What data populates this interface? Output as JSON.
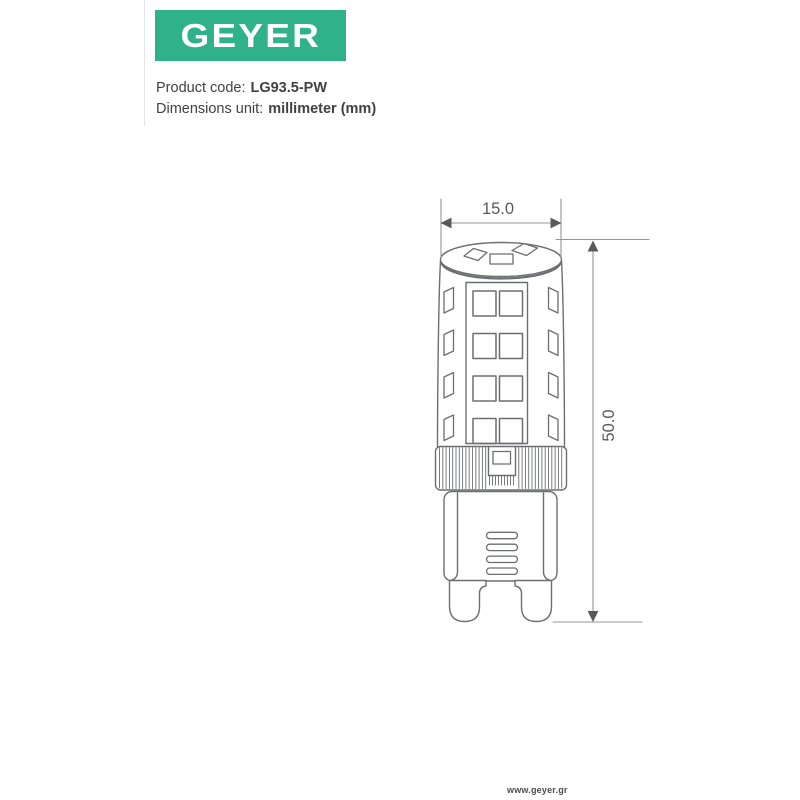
{
  "brand": {
    "logo_text": "GEYER",
    "green": "#2fb189"
  },
  "product": {
    "code_label": "Product code:",
    "code_value": "LG93.5-PW",
    "unit_label": "Dimensions unit:",
    "unit_value": "millimeter (mm)"
  },
  "drawing": {
    "type": "technical-dimension-drawing",
    "subject": "G9 LED lamp",
    "width_mm": "15.0",
    "height_mm": "50.0",
    "outline_color": "#6d6e71",
    "dimension_line_color": "#939598",
    "dimension_text_color": "#58595b"
  },
  "footer": {
    "website": "www.geyer.gr"
  }
}
